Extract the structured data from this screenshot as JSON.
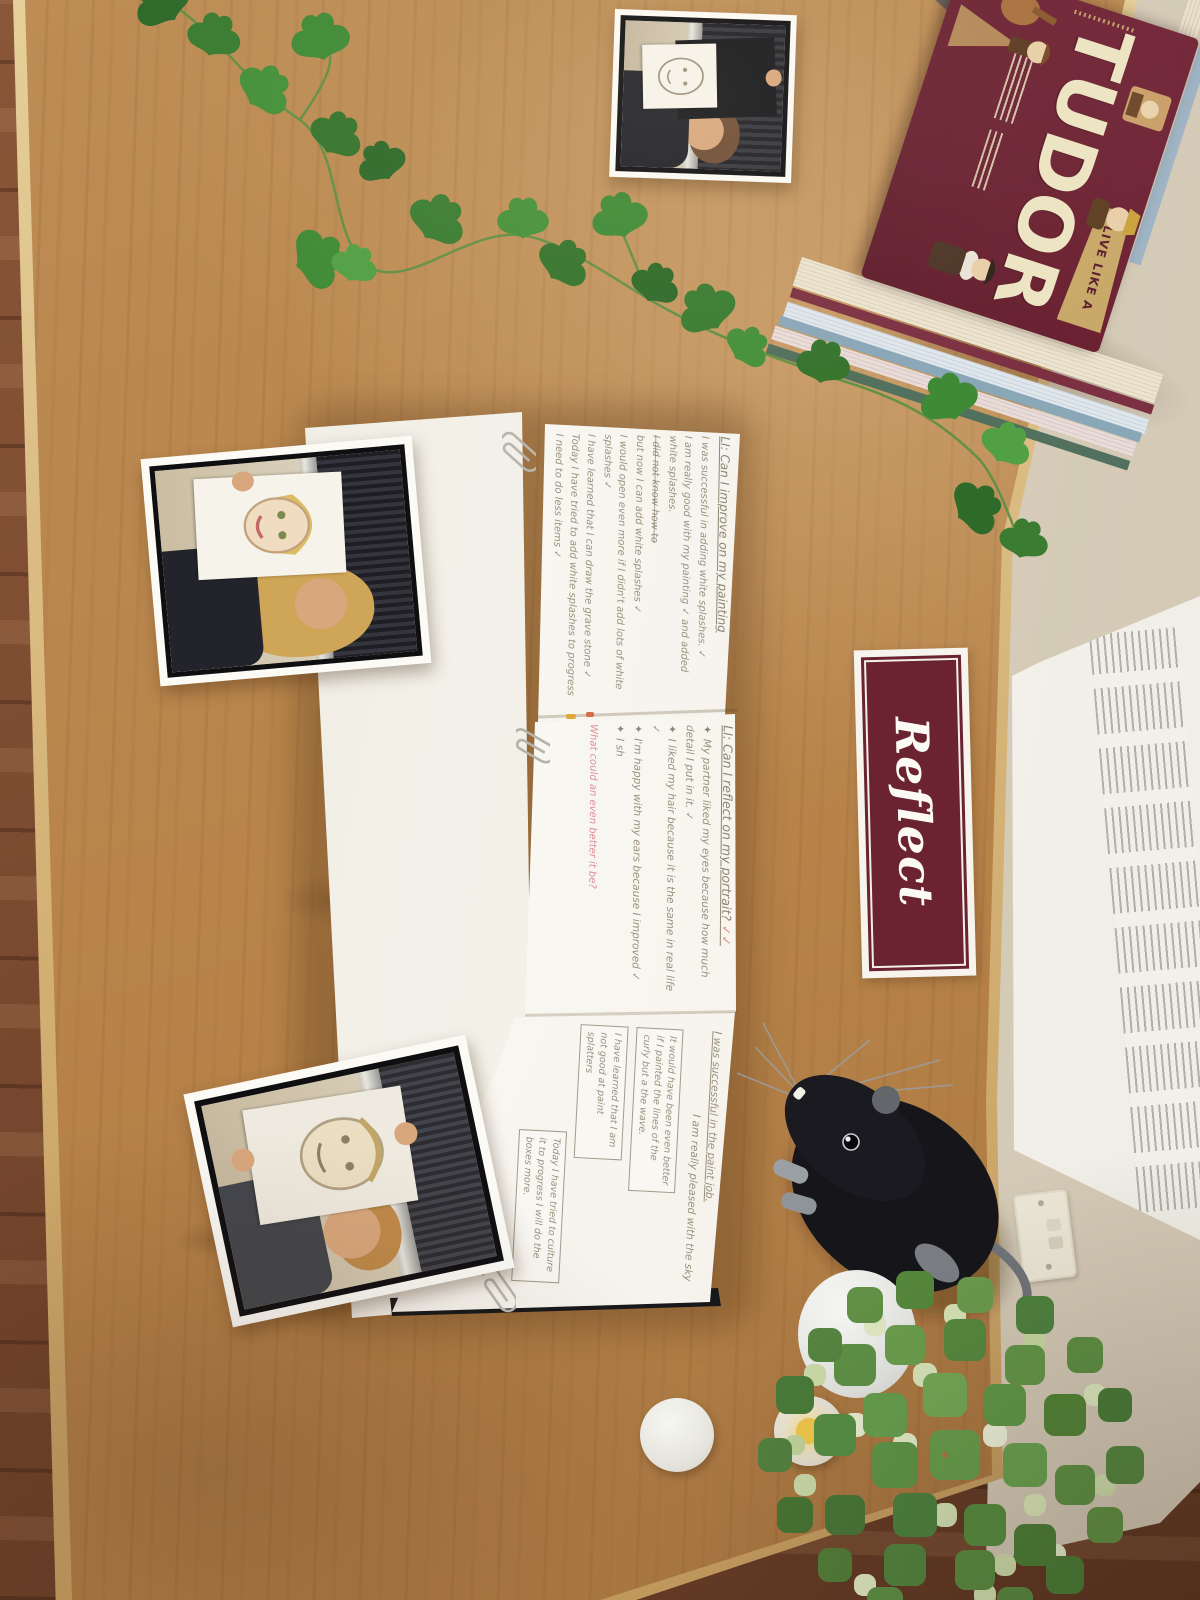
{
  "scene": {
    "description": "Top-down photo of a classroom reflection display table: open pupil journal with handwritten self-assessment, printed photos of children holding portrait drawings, a Reflect sign, Tudor history books, ivy garland, plush rat and artificial plant",
    "colors": {
      "table_wood": "#b8854e",
      "floor_wood": "#7b4a30",
      "wall": "#d6ccba",
      "radiator": "#f3f1ea",
      "sign_maroon": "#6b2331",
      "book_maroon": "#6b2232",
      "book_gold": "#c9a96a",
      "book_cream": "#ece4c2",
      "pencil_grey": "#98917e",
      "teacher_pink": "#dd8d97"
    }
  },
  "sign": {
    "label": "Reflect"
  },
  "book": {
    "banner": "LIVE LIKE A",
    "title": "TUDOR"
  },
  "notebook": {
    "page1": {
      "title": "LI: Can I improve on my painting",
      "lines": [
        "I was successful in adding white splashes. ✓",
        "I am really good with my painting ✓ and added white splashes.",
        "I did not know how to",
        "but now I can add white splashes ✓",
        "I would open even more if I didn't add lots of white splashes ✓",
        "I have learned that I can draw the grave stone ✓",
        "Today I have tried to add white splashes to progress I need to do less items ✓"
      ]
    },
    "page2": {
      "title": "LI: Can I reflect on my portrait?",
      "title_ticks": "✓✓",
      "bullet_marker": "✦",
      "bullets": [
        "My partner liked my eyes because how much detail I put in it. ✓",
        "I liked my hair because it is the same in real life ✓",
        "I'm happy with my ears because I improved ✓",
        "I sh"
      ],
      "teacher_comment": "What could an even better it be?"
    },
    "page3": {
      "line1": "I was successful in the paint job.",
      "line2": "I am really pleased with the sky",
      "boxes": [
        "I have learned that I am not good at paint splatters",
        "It would have been even better if I painted the lines of the curly but a the wave.",
        "Today I have tried to culture it to progress I will do the boxes more."
      ]
    }
  }
}
